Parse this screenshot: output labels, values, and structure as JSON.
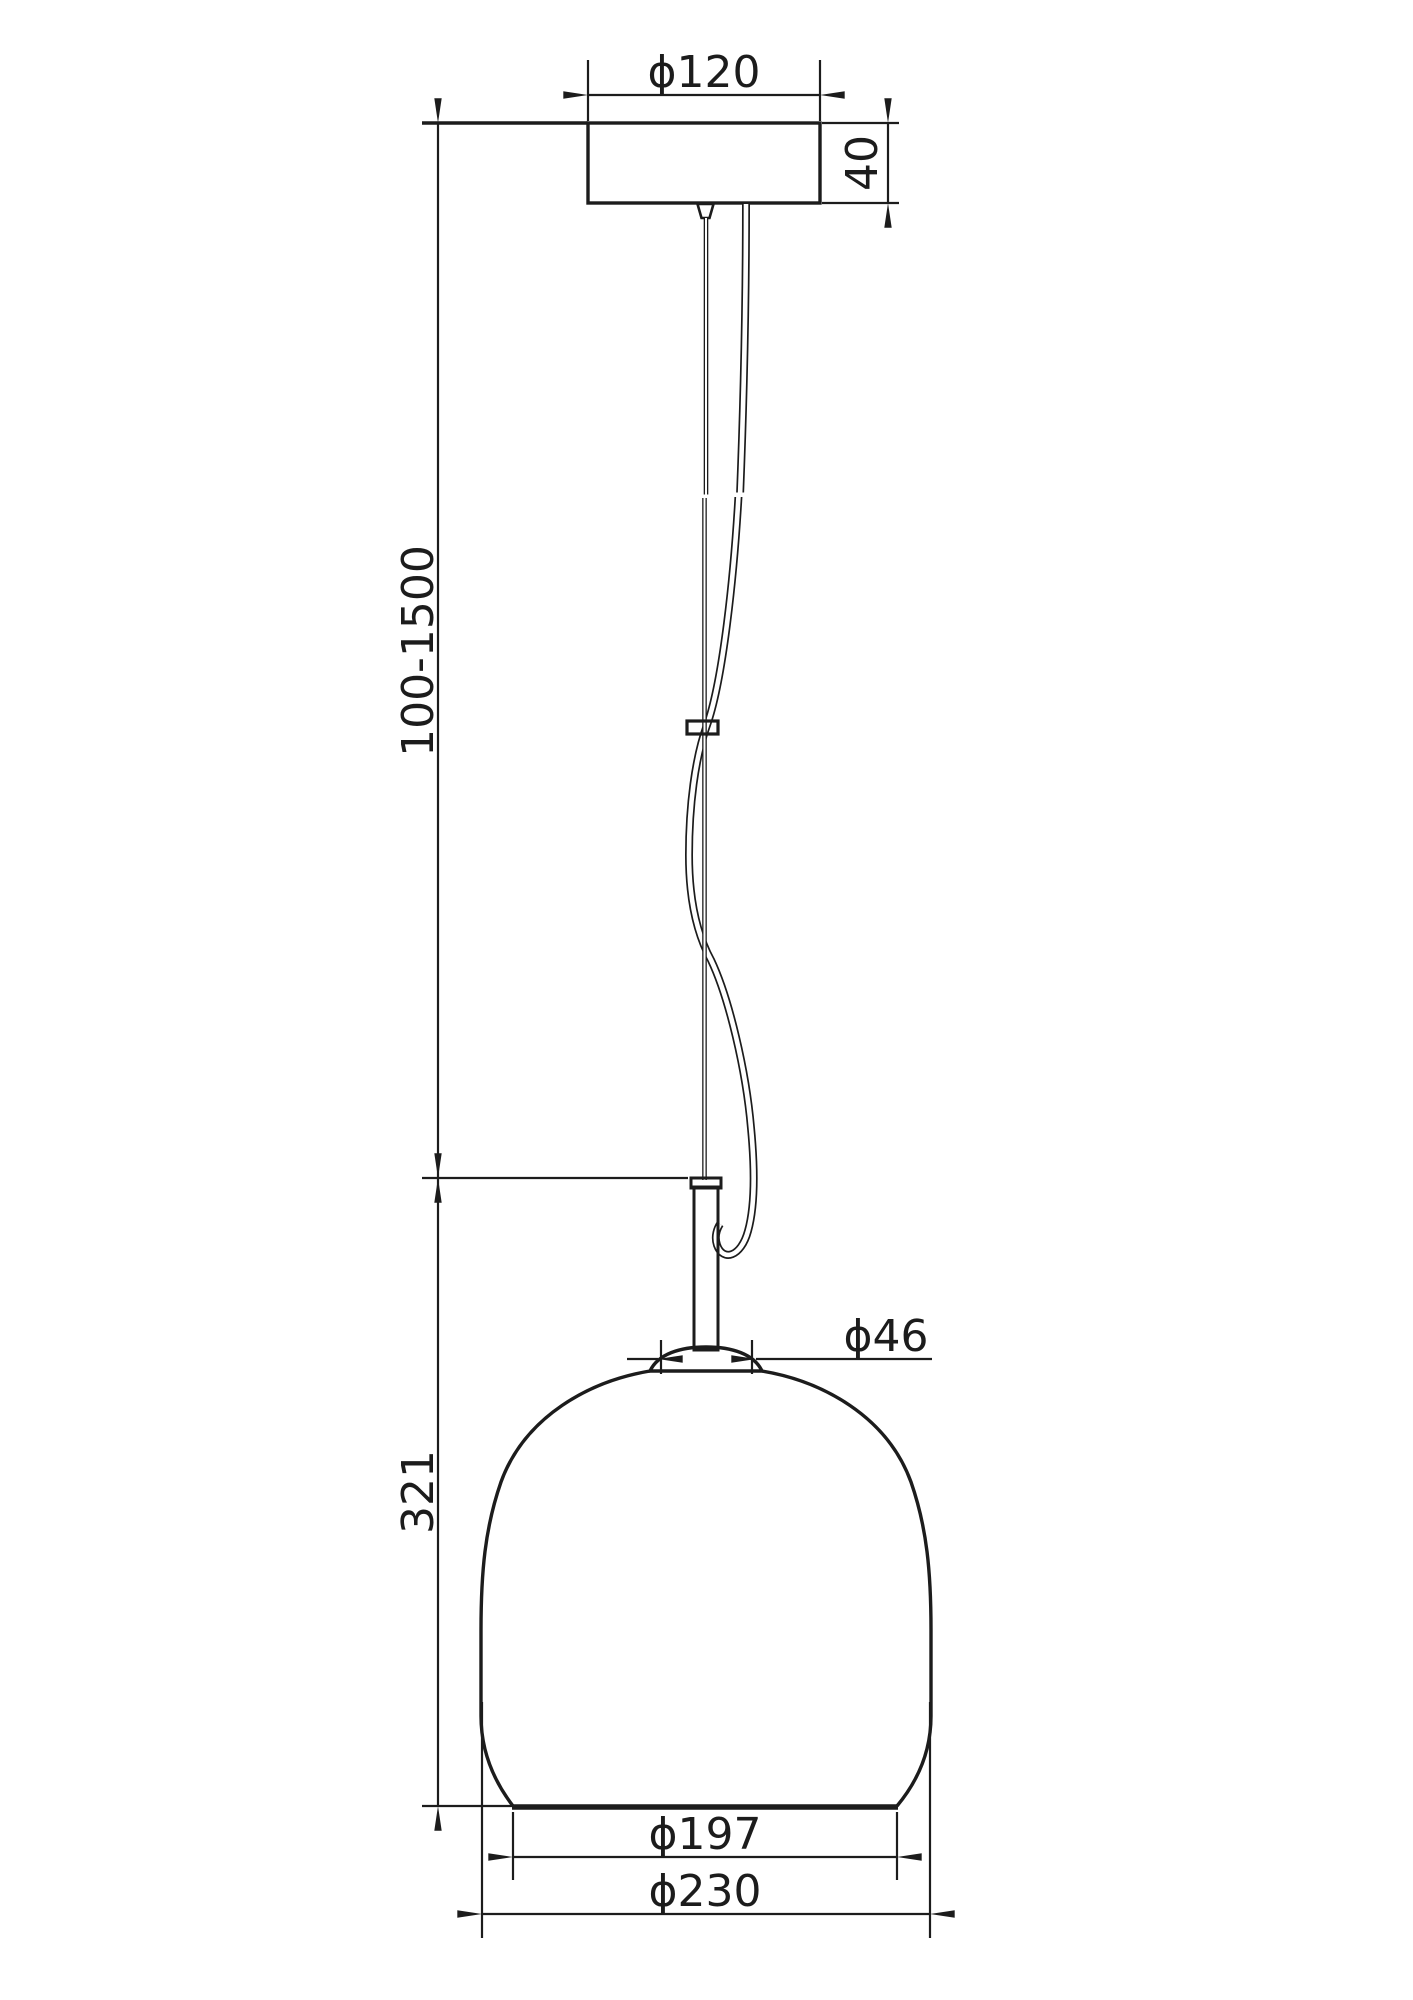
{
  "page": {
    "background": "#ffffff",
    "ink": "#1c1c1c"
  },
  "drawing": {
    "subject": "Pendant lamp dimensional drawing",
    "dimensions": {
      "canopy_diameter": {
        "label": "ϕ120",
        "value": 120
      },
      "canopy_height": {
        "label": "40",
        "value": 40
      },
      "suspension_length": {
        "label": "100-1500",
        "min": 100,
        "max": 1500
      },
      "neck_diameter": {
        "label": "ϕ46",
        "value": 46
      },
      "shade_height": {
        "label": "321",
        "value": 321
      },
      "opening_diameter": {
        "label": "ϕ197",
        "value": 197
      },
      "shade_diameter": {
        "label": "ϕ230",
        "value": 230
      }
    }
  }
}
